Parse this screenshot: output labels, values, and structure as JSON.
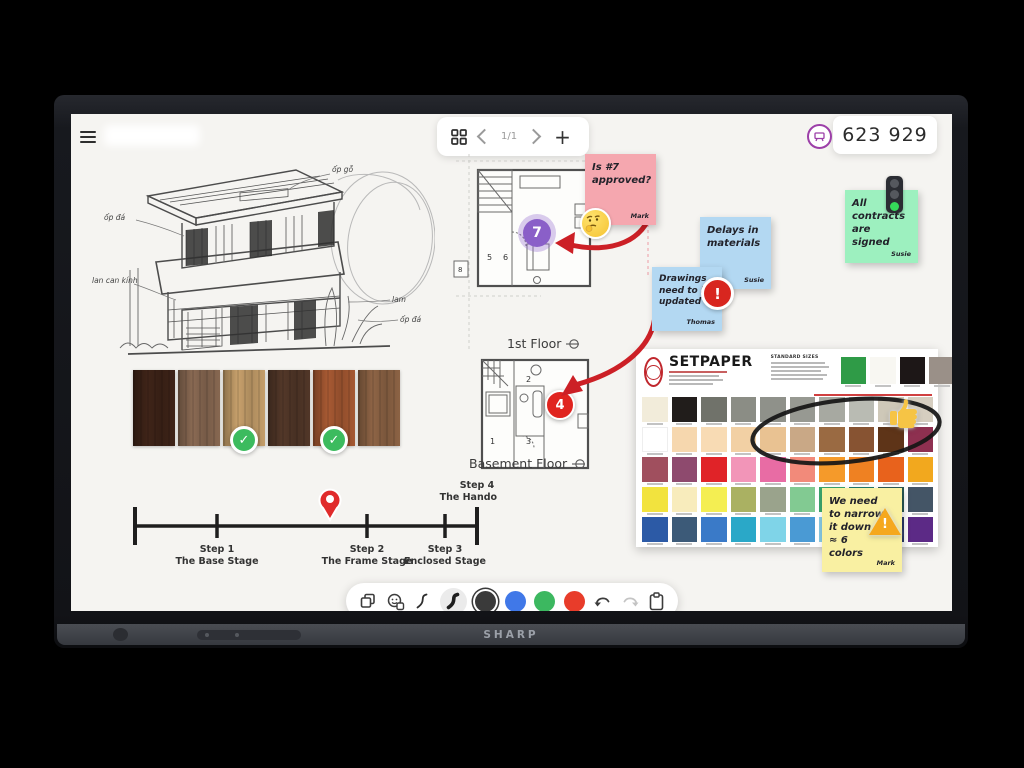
{
  "device": {
    "brand_label": "SHARP"
  },
  "screen": {
    "topbar": {
      "page_indicator": "1/1",
      "session_code": "623 929"
    },
    "canvas": {
      "sketch": {
        "annotations": [
          "ốp đá",
          "ốp gỗ",
          "lan can kính",
          "lam",
          "ốp đá"
        ]
      },
      "wood_samples": {
        "colors": [
          "#3f2418",
          "#8a6a53",
          "#c8a16c",
          "#533829",
          "#a85a33",
          "#8f6546"
        ],
        "approved": [
          2,
          4
        ],
        "check_glyph": "✓"
      },
      "floor_plans": [
        {
          "label": "1st Floor",
          "marker": "7",
          "rooms": [
            "5",
            "6"
          ],
          "annex": "8"
        },
        {
          "label": "Basement Floor",
          "marker": "4",
          "rooms": [
            "1",
            "2",
            "3"
          ]
        }
      ],
      "stickies": {
        "pink": {
          "text": "Is #7 approved?",
          "author": "Mark",
          "color": "#f5a7af",
          "icon": "thinking-face-emoji"
        },
        "green": {
          "text": "All contracts are signed",
          "author": "Susie",
          "color": "#9df0bf",
          "icon": "traffic-light-emoji"
        },
        "blue_top": {
          "text": "Delays in materials",
          "author": "Susie",
          "color": "#b3d8f2"
        },
        "blue_bottom": {
          "text": "Drawings need to be updated",
          "author": "Thomas",
          "color": "#b3d8f2",
          "icon": "alert-sticker"
        },
        "yellow": {
          "text": "We need to narrow it down – ≈ 6 colors",
          "author": "Mark",
          "color": "#f9f0a2",
          "icon": "warning-emoji",
          "exclaim": "!"
        }
      },
      "color_chart": {
        "brand": "SETPAPER",
        "sizes_heading": "STANDARD SIZES",
        "header_swatches": [
          "#2f9b47",
          "#f8f7f2",
          "#1d1717",
          "#9a9088"
        ],
        "rows": [
          [
            "#f2ecda",
            "#211d1b",
            "#70726a",
            "#8b8d85",
            "#8f918a",
            "#979992",
            "#a7a9a1",
            "#b9bbb3",
            "#cec8b8",
            "#d6cec0"
          ],
          [
            "#ffffff",
            "#f6d7ae",
            "#f8dbb4",
            "#f2d0a4",
            "#e9c292",
            "#c9a886",
            "#9a6a42",
            "#875332",
            "#5e3418",
            "#8e3050"
          ],
          [
            "#a04f5e",
            "#8e4a6e",
            "#e02328",
            "#f295b8",
            "#e86ca4",
            "#f28a7a",
            "#f59a2a",
            "#ef8122",
            "#e8621c",
            "#f2a81e"
          ],
          [
            "#f2e33e",
            "#f8ecbc",
            "#f4ee52",
            "#aab162",
            "#9aa38c",
            "#82ca92",
            "#3ba56c",
            "#20796a",
            "#2a5a55",
            "#445566"
          ],
          [
            "#2c5aa6",
            "#3c5a78",
            "#3a7ac8",
            "#2aa8c8",
            "#7fd4e8",
            "#4a9ad4",
            "#86c8e2",
            "#3a6ab8",
            "#2a3a6a",
            "#5c2a86"
          ]
        ]
      },
      "timeline": {
        "steps": [
          {
            "name": "Step 1",
            "stage": "The Base Stage"
          },
          {
            "name": "Step 2",
            "stage": "The Frame Stage"
          },
          {
            "name": "Step 3",
            "stage": "Enclosed Stage"
          },
          {
            "name": "Step 4",
            "stage": "The Handover"
          }
        ]
      }
    },
    "toolbar": {
      "pen_colors": [
        "#3a3a3a",
        "#4078e8",
        "#3cb860",
        "#e83c2a"
      ]
    }
  }
}
